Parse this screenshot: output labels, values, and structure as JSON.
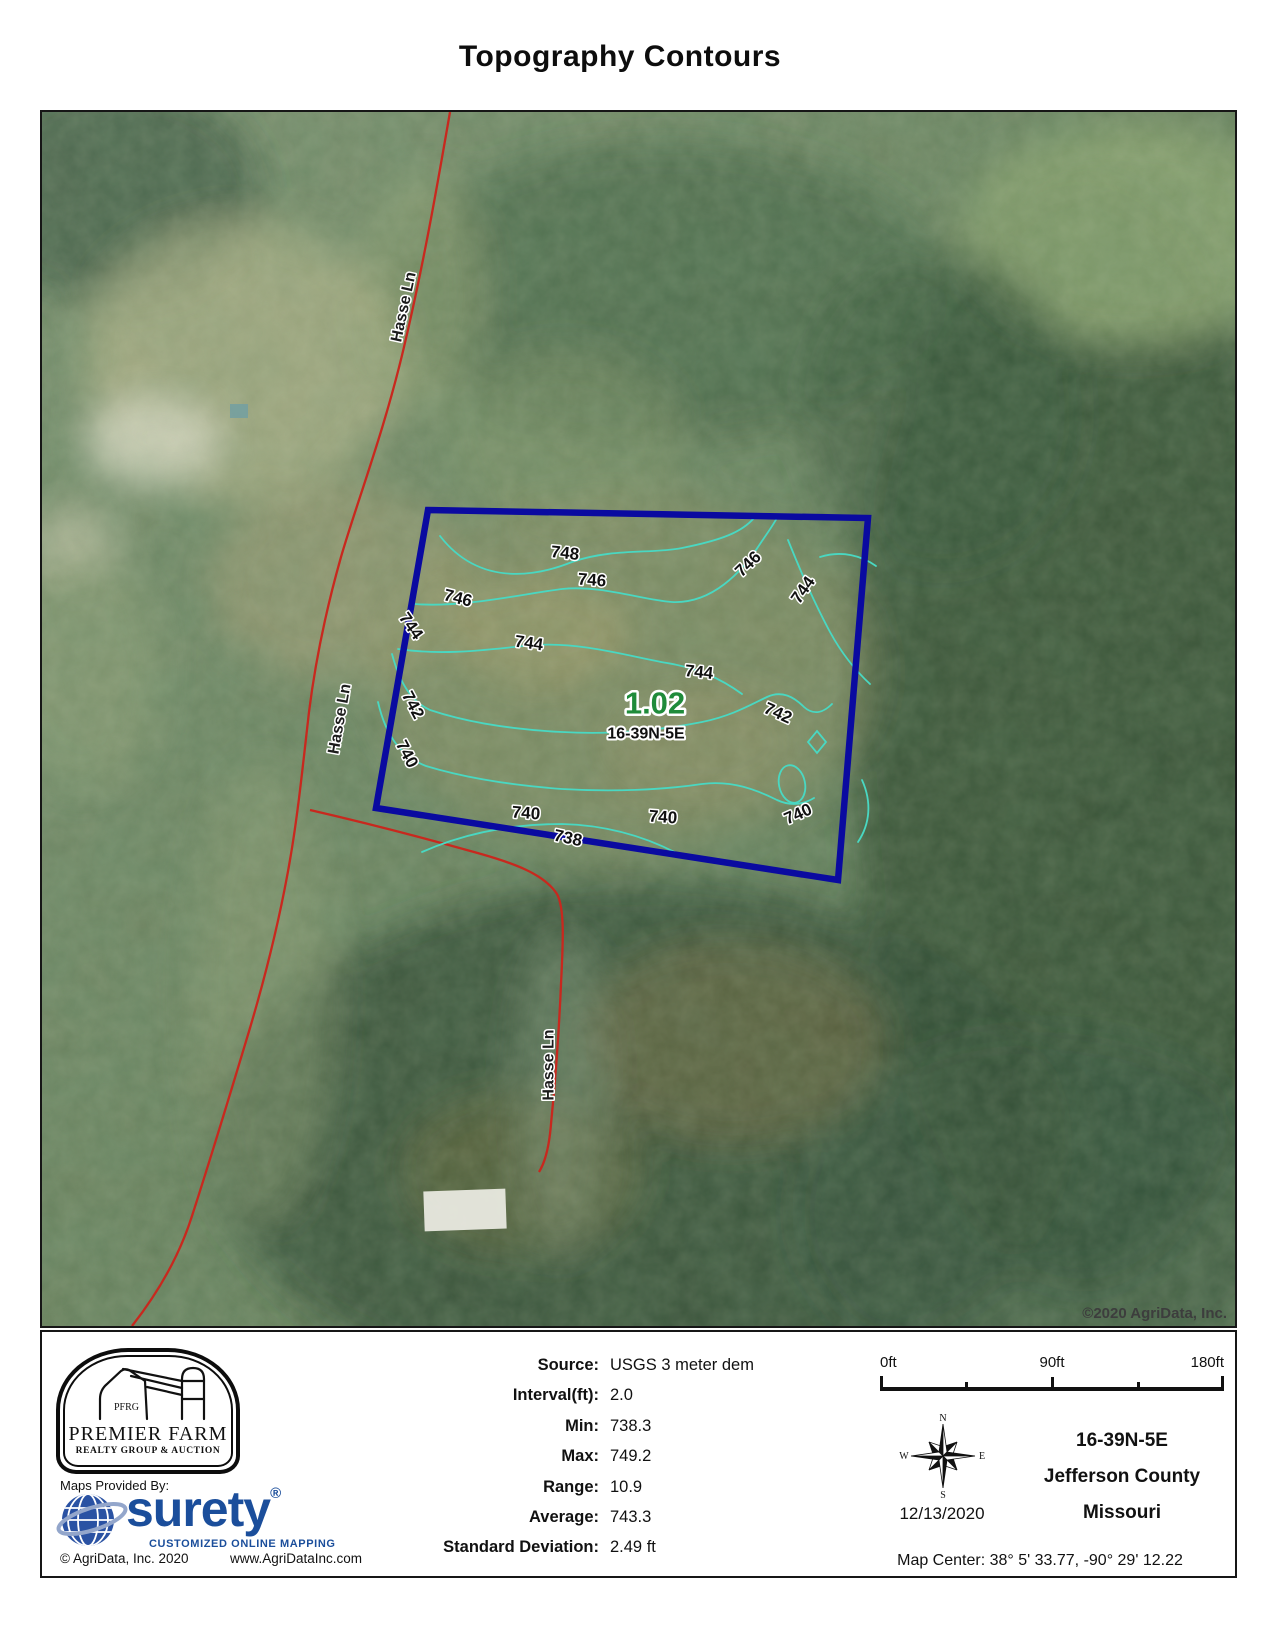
{
  "title": "Topography Contours",
  "map": {
    "copyright": "©2020 AgriData, Inc.",
    "parcel": {
      "area": "1.02",
      "section": "16-39N-5E"
    },
    "road_labels": [
      {
        "text": "Hasse Ln"
      },
      {
        "text": "Hasse Ln"
      },
      {
        "text": "Hasse Ln"
      }
    ],
    "contour_labels": [
      {
        "text": "748"
      },
      {
        "text": "746"
      },
      {
        "text": "746"
      },
      {
        "text": "746"
      },
      {
        "text": "744"
      },
      {
        "text": "744"
      },
      {
        "text": "744"
      },
      {
        "text": "744"
      },
      {
        "text": "742"
      },
      {
        "text": "742"
      },
      {
        "text": "740"
      },
      {
        "text": "740"
      },
      {
        "text": "740"
      },
      {
        "text": "740"
      },
      {
        "text": "738"
      }
    ],
    "colors": {
      "boundary": "#0a0aa0",
      "contour": "#49d8c2",
      "road": "#c8281e",
      "parcel_area_text": "#1f8b3a"
    }
  },
  "footer": {
    "premier_farm": {
      "initials": "PFRG",
      "name": "PREMIER FARM",
      "tagline": "REALTY GROUP & AUCTION"
    },
    "maps_provided_by": "Maps Provided By:",
    "surety": {
      "wordmark": "surety",
      "registered": "®",
      "tagline": "CUSTOMIZED ONLINE MAPPING",
      "color": "#1b4e9b"
    },
    "agridata_copyright": "© AgriData, Inc. 2020",
    "agridata_url": "www.AgriDataInc.com",
    "stats": [
      {
        "label": "Source:",
        "value": "USGS 3 meter dem"
      },
      {
        "label": "Interval(ft):",
        "value": "2.0"
      },
      {
        "label": "Min:",
        "value": "738.3"
      },
      {
        "label": "Max:",
        "value": "749.2"
      },
      {
        "label": "Range:",
        "value": "10.9"
      },
      {
        "label": "Average:",
        "value": "743.3"
      },
      {
        "label": "Standard Deviation:",
        "value": "2.49 ft"
      }
    ],
    "scale": {
      "labels": [
        "0ft",
        "90ft",
        "180ft"
      ]
    },
    "compass": {
      "n": "N",
      "e": "E",
      "s": "S",
      "w": "W"
    },
    "date": "12/13/2020",
    "location": {
      "section": "16-39N-5E",
      "county": "Jefferson County",
      "state": "Missouri"
    },
    "map_center": "Map Center: 38° 5' 33.77,  -90° 29' 12.22"
  }
}
